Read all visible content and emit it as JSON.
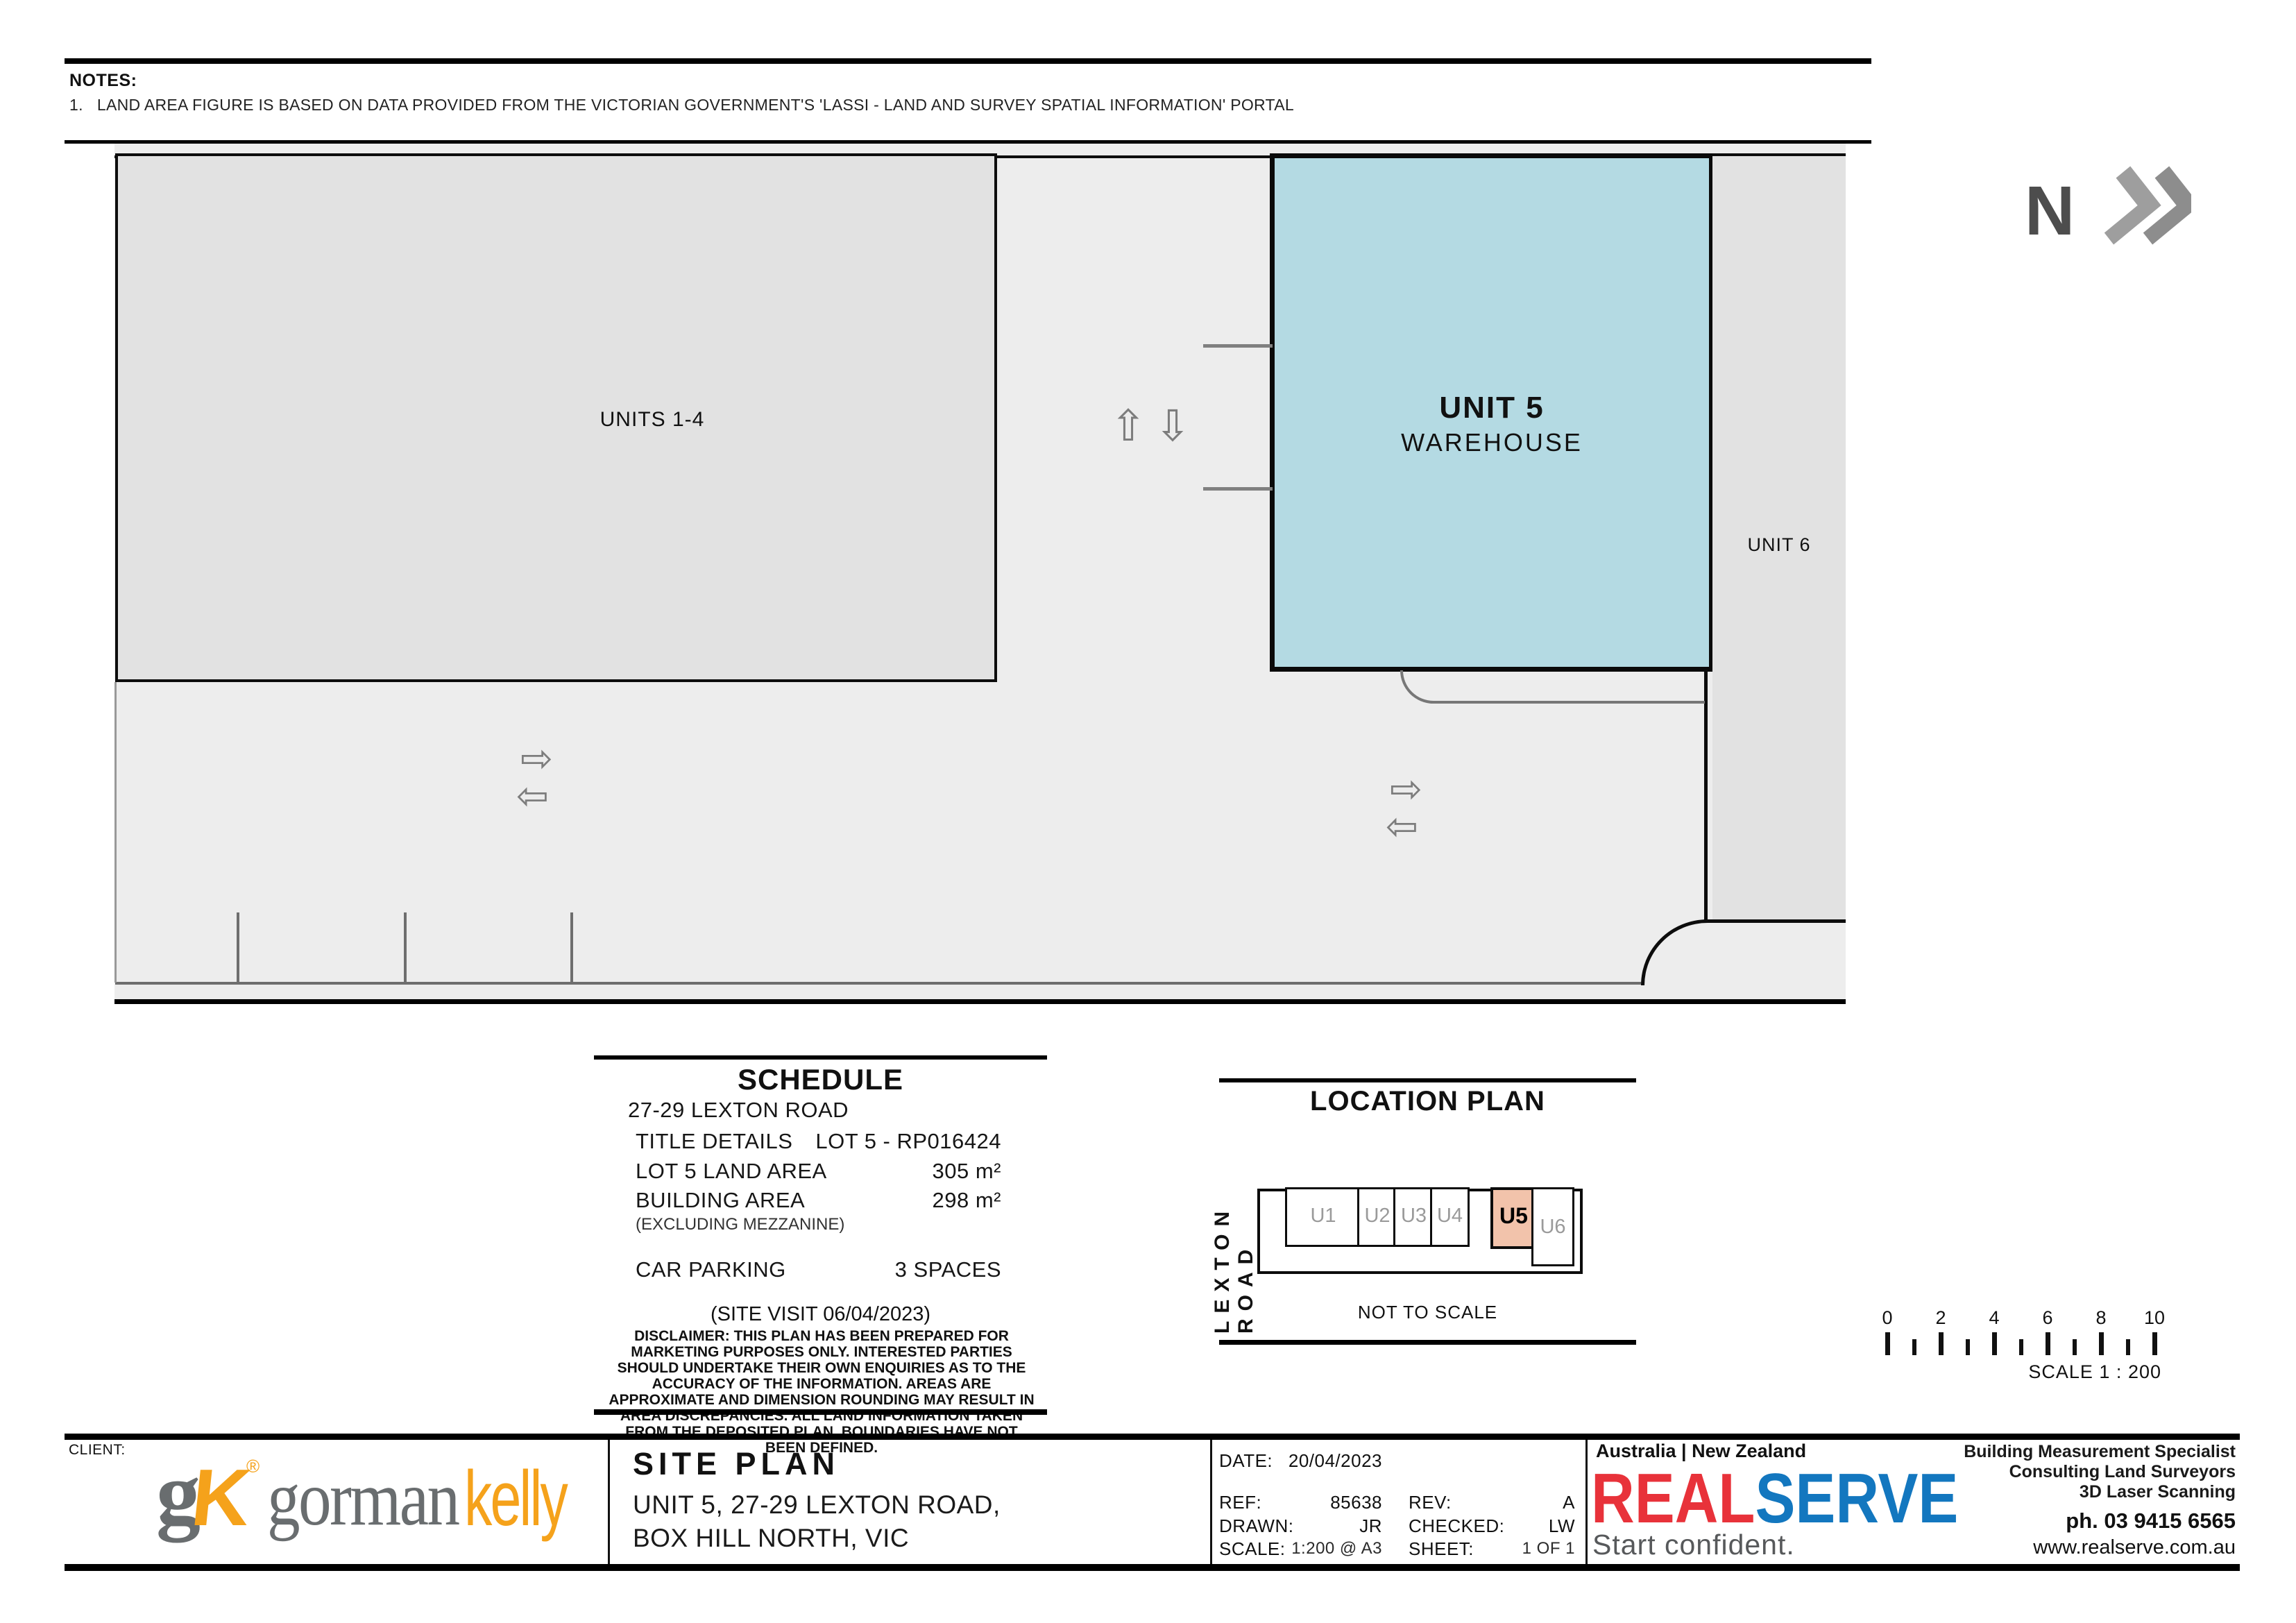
{
  "notes": {
    "heading": "NOTES:",
    "item_1": "1.   LAND AREA FIGURE IS BASED ON DATA PROVIDED FROM THE VICTORIAN GOVERNMENT'S 'LASSI - LAND AND SURVEY SPATIAL INFORMATION' PORTAL"
  },
  "north_arrow": {
    "label": "N"
  },
  "site_plan": {
    "units_1_4_label": "UNITS 1-4",
    "unit5_name": "UNIT 5",
    "unit5_type": "WAREHOUSE",
    "unit6_label": "UNIT 6",
    "icons": {
      "up": "⇧",
      "down": "⇩",
      "right": "⇨",
      "left": "⇦"
    }
  },
  "schedule": {
    "title": "SCHEDULE",
    "address": "27-29 LEXTON ROAD",
    "rows": [
      {
        "label": "TITLE DETAILS",
        "value": "LOT 5 - RP016424"
      },
      {
        "label": "LOT 5 LAND AREA",
        "value": "305 m²"
      },
      {
        "label": "BUILDING AREA",
        "value": "298 m²"
      }
    ],
    "building_note": "(EXCLUDING MEZZANINE)",
    "car_parking_label": "CAR PARKING",
    "car_parking_value": "3 SPACES",
    "site_visit": "(SITE VISIT  06/04/2023)",
    "disclaimer": "DISCLAIMER: THIS PLAN HAS BEEN PREPARED FOR MARKETING PURPOSES ONLY. INTERESTED PARTIES SHOULD UNDERTAKE THEIR OWN ENQUIRIES AS TO THE ACCURACY OF THE INFORMATION. AREAS ARE APPROXIMATE AND DIMENSION ROUNDING MAY RESULT IN AREA DISCREPANCIES. ALL LAND INFORMATION TAKEN FROM THE DEPOSITED PLAN. BOUNDARIES HAVE NOT BEEN DEFINED."
  },
  "location_plan": {
    "title": "LOCATION PLAN",
    "road": "LEXTON ROAD",
    "unit_labels": [
      "U1",
      "U2",
      "U3",
      "U4",
      "U5",
      "U6"
    ],
    "highlighted_unit": "U5",
    "not_to_scale": "NOT TO SCALE"
  },
  "scale_bar": {
    "ticks": [
      "0",
      "2",
      "4",
      "6",
      "8",
      "10"
    ],
    "label": "SCALE 1 : 200"
  },
  "title_block": {
    "client_heading": "CLIENT:",
    "client_logo": {
      "mono_g": "g",
      "mono_k": "K",
      "registered": "®",
      "word_gorman": "gorman",
      "word_kelly": "kelly"
    },
    "drawing_title": "SITE PLAN",
    "drawing_address_1": "UNIT 5, 27-29 LEXTON ROAD,",
    "drawing_address_2": "BOX HILL NORTH, VIC",
    "meta": {
      "date_label": "DATE:",
      "date": "20/04/2023",
      "ref_label": "REF:",
      "ref": "85638",
      "rev_label": "REV:",
      "rev": "A",
      "drawn_label": "DRAWN:",
      "drawn": "JR",
      "checked_label": "CHECKED:",
      "checked": "LW",
      "scale_label": "SCALE:",
      "scale": "1:200 @ A3",
      "sheet_label": "SHEET:",
      "sheet": "1 OF 1"
    },
    "realserve": {
      "region": "Australia | New Zealand",
      "brand_real": "REAL",
      "brand_serve": "SERVE",
      "tagline": "Start confident.",
      "services": [
        "Building Measurement Specialist",
        "Consulting Land Surveyors",
        "3D Laser Scanning"
      ],
      "phone": "ph. 03 9415 6565",
      "website": "www.realserve.com.au"
    }
  },
  "colors": {
    "unit5_fill": "#B4DAE3",
    "unit_block_gray": "#E2E2E2",
    "site_background": "#EDEDED",
    "u5_highlight": "#F2C3AB",
    "gorman_gray": "#696D6F",
    "kelly_orange": "#F5A21B",
    "realserve_red": "#E8323A",
    "realserve_blue": "#1377BF"
  }
}
